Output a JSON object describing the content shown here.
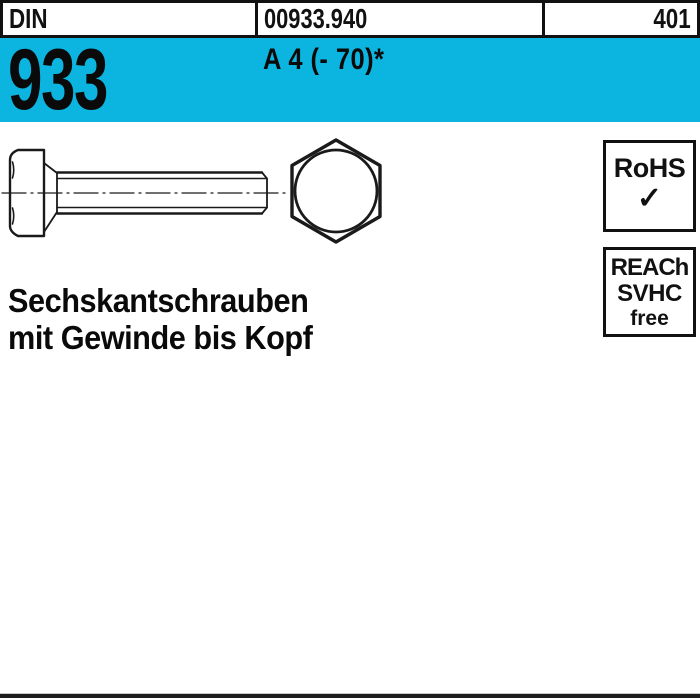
{
  "header": {
    "standard_label": "DIN",
    "standard_number": "933",
    "article_number": "00933.940",
    "page_number": "401",
    "material_spec": "A 4 (- 70)*"
  },
  "badges": {
    "rohs": {
      "label": "RoHS",
      "check_glyph": "✓"
    },
    "reach": {
      "lines": [
        "REACh",
        "SVHC",
        "free"
      ]
    }
  },
  "title": {
    "line1": "Sechskantschrauben",
    "line2": "mit Gewinde bis Kopf"
  },
  "drawing": {
    "description": "hex head bolt, side view with centerline and hex front view"
  },
  "colors": {
    "band_cyan": "#0cb5e0",
    "ink": "#111111",
    "background": "#ffffff"
  }
}
